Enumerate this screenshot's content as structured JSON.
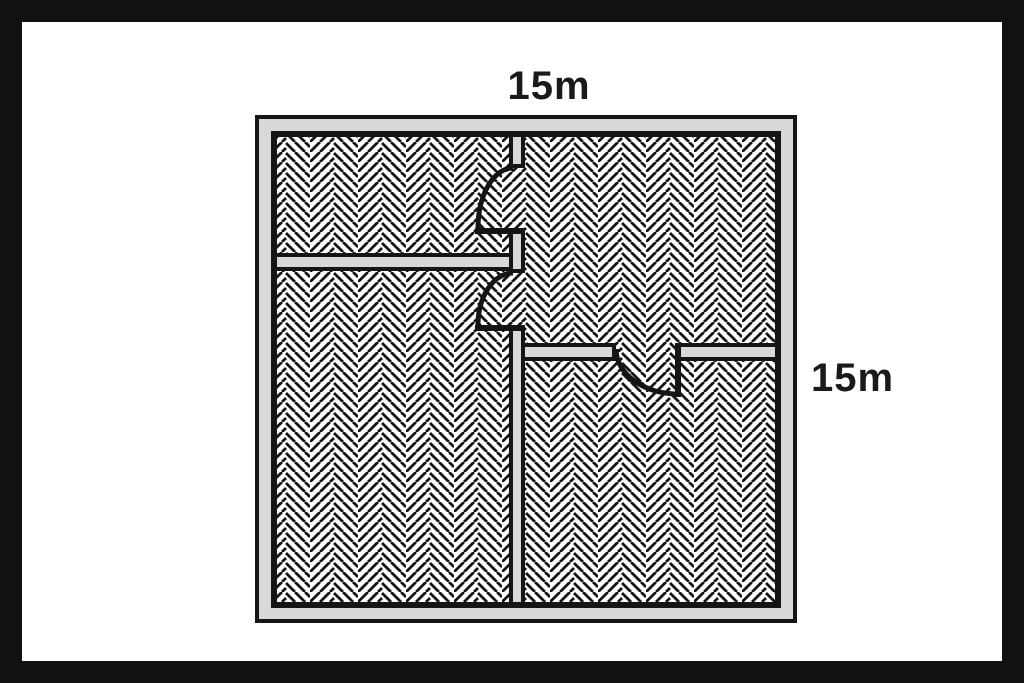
{
  "labels": {
    "top_dimension": "15m",
    "right_dimension": "15m"
  },
  "colors": {
    "frame": "#111111",
    "line": "#151515",
    "wall_fill": "#d8d8d8",
    "floor_bg": "#ffffff",
    "label_text": "#1a1a1a"
  },
  "diagram": {
    "type": "floor-plan",
    "outer_width": "15m",
    "outer_height": "15m",
    "door_count": 3
  }
}
